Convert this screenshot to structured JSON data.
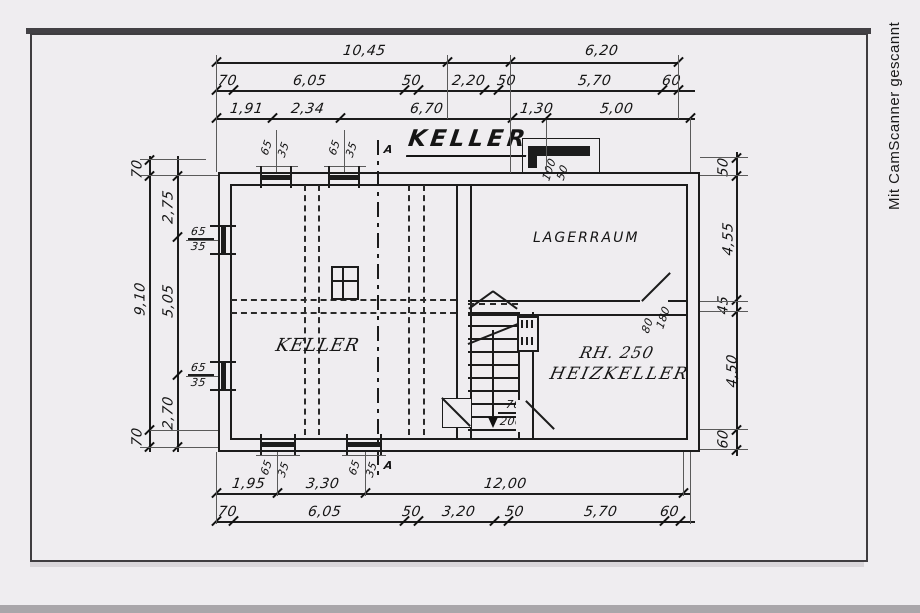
{
  "watermark": "Mit CamScanner gescannt",
  "plan": {
    "title": "KELLER",
    "rooms": {
      "keller": "KELLER",
      "lagerraum": "LAGERRAUM",
      "heiz_line1": "RH. 250",
      "heiz_line2": "HEIZKELLER"
    },
    "labels": {
      "door_keller_w": "70",
      "door_keller_h": "200",
      "door_lager_w": "80",
      "door_lager_h": "180",
      "lightwell_w": "100",
      "lightwell_h": "50",
      "window_w": "65",
      "window_h": "35",
      "section": "A"
    }
  },
  "dims": {
    "top_row1": [
      "10,45",
      "6,20"
    ],
    "top_row2": [
      "70",
      "6,05",
      "50",
      "2,20",
      "50",
      "5,70",
      "60"
    ],
    "top_row3": [
      "1,91",
      "2,34",
      "6,70",
      "1,30",
      "5,00"
    ],
    "left_outer": [
      "70",
      "9,10",
      "70"
    ],
    "left_inner": [
      "2,75",
      "5,05",
      "2,70"
    ],
    "right_col": [
      "50",
      "4,55",
      "45",
      "4,50",
      "60"
    ],
    "bottom_row1": [
      "1,95",
      "3,30",
      "12,00"
    ],
    "bottom_row2": [
      "70",
      "6,05",
      "50",
      "3,20",
      "50",
      "5,70",
      "60"
    ]
  }
}
